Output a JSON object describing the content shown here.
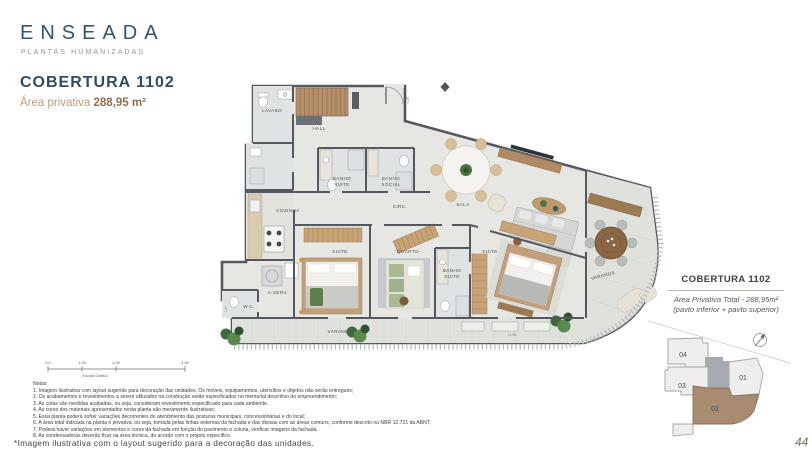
{
  "brand": {
    "logo": "ENSEADA",
    "tagline": "PLANTAS HUMANIZADAS"
  },
  "header": {
    "title": "COBERTURA 1102",
    "area_label": "Área privativa",
    "area_value": "288,95 m²"
  },
  "plan": {
    "rooms": [
      {
        "label": "LAVABO"
      },
      {
        "label": "HALL"
      },
      {
        "label": "BANHO\nSUITE"
      },
      {
        "label": "BANHO\nSOCIAL"
      },
      {
        "label": "COZINHA"
      },
      {
        "label": "CIRC."
      },
      {
        "label": "SALA"
      },
      {
        "label": "SUITE"
      },
      {
        "label": "QUARTO"
      },
      {
        "label": "BANHO\nSUITE"
      },
      {
        "label": "SUITE"
      },
      {
        "label": "A.SERV."
      },
      {
        "label": "W.C."
      },
      {
        "label": "VARANDA"
      },
      {
        "label": "VARANDA"
      }
    ],
    "dimensions": [
      {
        "label": "0.25"
      },
      {
        "label": "6.04"
      },
      {
        "label": "11.06"
      },
      {
        "label": "1.50"
      }
    ],
    "scale": {
      "ticks": [
        "0.0",
        "1.00",
        "2.00",
        "4.00"
      ],
      "label": "Escala Gráfica"
    }
  },
  "sidebar": {
    "title": "COBERTURA 1102",
    "area_line": "Área Privativa Total - 288,95m²",
    "pav_line": "(pavto inferior + pavto superior)",
    "keyplan": {
      "units": [
        {
          "id": "01"
        },
        {
          "id": "02"
        },
        {
          "id": "03"
        },
        {
          "id": "04"
        }
      ],
      "highlighted_unit": "02"
    }
  },
  "notes": {
    "heading": "Notas:",
    "items": [
      "1. Imagem ilustrativa com layout sugerido para decoração das unidades. Os móveis, equipamentos, utensílios e objetos não serão entregues;",
      "2. Os acabamentos e revestimentos a serem utilizados na construção estão especificados no memorial descritivo do empreendimento;",
      "3. As cotas são medidas acabadas, ou seja, consideram revestimento especificado para cada ambiente.",
      "4. As cores dos materiais apresentados nesta planta são meramente ilustrativas;",
      "5. Essa planta poderá sofrer variações decorrentes do atendimento das posturas municipais, concessionárias e do local;",
      "6. A área total indicada na planta é privativa, ou seja, tomada pelas linhas externas da fachada e das divisas com as áreas comuns, conforme descrito na NBR 12.721 da ABNT;",
      "7. Poderá haver variações em elementos e cores da fachada em função do pavimento e coluna, verificar imagens da fachada.",
      "8. As condensadoras deverão ficar na área técnica, de acordo com o projeto específico."
    ]
  },
  "footer": {
    "disclaimer": "*Imagem ilustrativa com o layout sugerido para a decoração das unidades.",
    "page_number": "44"
  },
  "colors": {
    "navy": "#2e4c68",
    "tan": "#bb9c78",
    "tan_dark": "#8e6f4e",
    "wall": "#54595f",
    "wood": "#b5906b",
    "floor": "#e6e7e3",
    "varanda_floor": "#dfe2dc",
    "keyplan_highlight": "#a98b72",
    "plant_green": "#4c7344"
  }
}
